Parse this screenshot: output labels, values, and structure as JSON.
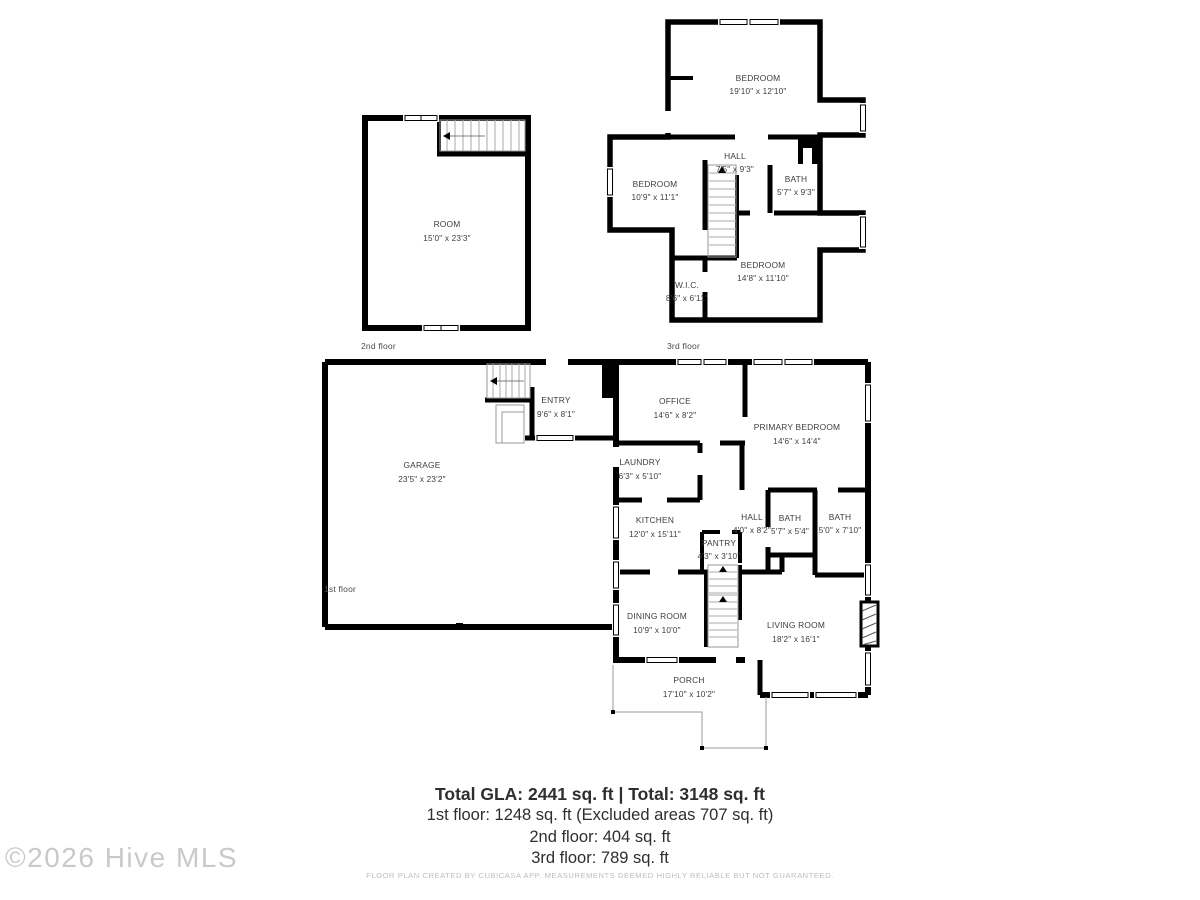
{
  "summary": {
    "total_line": "Total GLA: 2441 sq. ft | Total: 3148 sq. ft",
    "first_floor_line": "1st floor: 1248 sq. ft (Excluded areas 707 sq. ft)",
    "second_floor_line": "2nd floor: 404 sq. ft",
    "third_floor_line": "3rd floor: 789 sq. ft"
  },
  "disclaimer": "FLOOR PLAN CREATED BY CUBICASA APP. MEASUREMENTS DEEMED HIGHLY RELIABLE BUT NOT GUARANTEED.",
  "watermark": "©2026 Hive MLS",
  "colors": {
    "walls": "#000000",
    "room_text": "#3d3d3d",
    "watermark": "#c9c9c9",
    "disclaimer": "#bdbdbd"
  },
  "floors": {
    "first": {
      "label": "1st floor",
      "rooms": {
        "garage": {
          "name": "GARAGE",
          "dims": "23'5\" x 23'2\""
        },
        "entry": {
          "name": "ENTRY",
          "dims": "9'6\" x 8'1\""
        },
        "office": {
          "name": "OFFICE",
          "dims": "14'6\" x 8'2\""
        },
        "primary": {
          "name": "PRIMARY BEDROOM",
          "dims": "14'6\" x 14'4\""
        },
        "laundry": {
          "name": "LAUNDRY",
          "dims": "6'3\" x 5'10\""
        },
        "kitchen": {
          "name": "KITCHEN",
          "dims": "12'0\" x 15'11\""
        },
        "pantry": {
          "name": "PANTRY",
          "dims": "4'3\" x 3'10\""
        },
        "hall": {
          "name": "HALL",
          "dims": "4'0\" x 8'2\""
        },
        "bath1": {
          "name": "BATH",
          "dims": "5'7\" x 5'4\""
        },
        "bath2": {
          "name": "BATH",
          "dims": "5'0\" x 7'10\""
        },
        "dining": {
          "name": "DINING ROOM",
          "dims": "10'9\" x 10'0\""
        },
        "living": {
          "name": "LIVING ROOM",
          "dims": "18'2\" x 16'1\""
        },
        "porch": {
          "name": "PORCH",
          "dims": "17'10\" x 10'2\""
        }
      }
    },
    "second": {
      "label": "2nd floor",
      "rooms": {
        "room": {
          "name": "ROOM",
          "dims": "15'0\" x 23'3\""
        }
      }
    },
    "third": {
      "label": "3rd floor",
      "rooms": {
        "bedroom_top": {
          "name": "BEDROOM",
          "dims": "19'10\" x 12'10\""
        },
        "hall": {
          "name": "HALL",
          "dims": "7'5\" x 9'3\""
        },
        "bedroom_left": {
          "name": "BEDROOM",
          "dims": "10'9\" x 11'1\""
        },
        "bath": {
          "name": "BATH",
          "dims": "5'7\" x 9'3\""
        },
        "bedroom_bottom": {
          "name": "BEDROOM",
          "dims": "14'8\" x 11'10\""
        },
        "wic": {
          "name": "W.I.C.",
          "dims": "8'6\" x 6'11\""
        }
      }
    }
  }
}
